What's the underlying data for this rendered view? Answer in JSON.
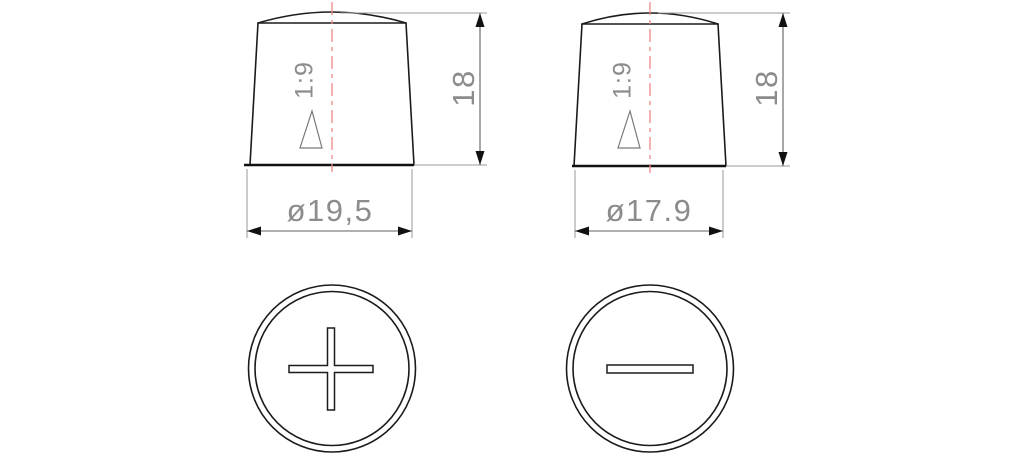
{
  "drawing": {
    "description": "Battery terminal posts technical drawing - side and top views",
    "colors": {
      "outline": "#1b1b1b",
      "base_line": "#111111",
      "centerline": "#ee8888",
      "extension_line": "#9a9a9a",
      "dimension_line": "#5f5f5f",
      "arrow": "#111111",
      "dimension_text": "#8c8c8c",
      "taper_symbol": "#7a7a7a"
    },
    "positive_terminal": {
      "side_view": {
        "taper": "1:9",
        "height": "18",
        "diameter": "ø19,5"
      },
      "top_view": {
        "polarity_symbol": "plus"
      }
    },
    "negative_terminal": {
      "side_view": {
        "taper": "1:9",
        "height": "18",
        "diameter": "ø17.9"
      },
      "top_view": {
        "polarity_symbol": "minus"
      }
    }
  }
}
